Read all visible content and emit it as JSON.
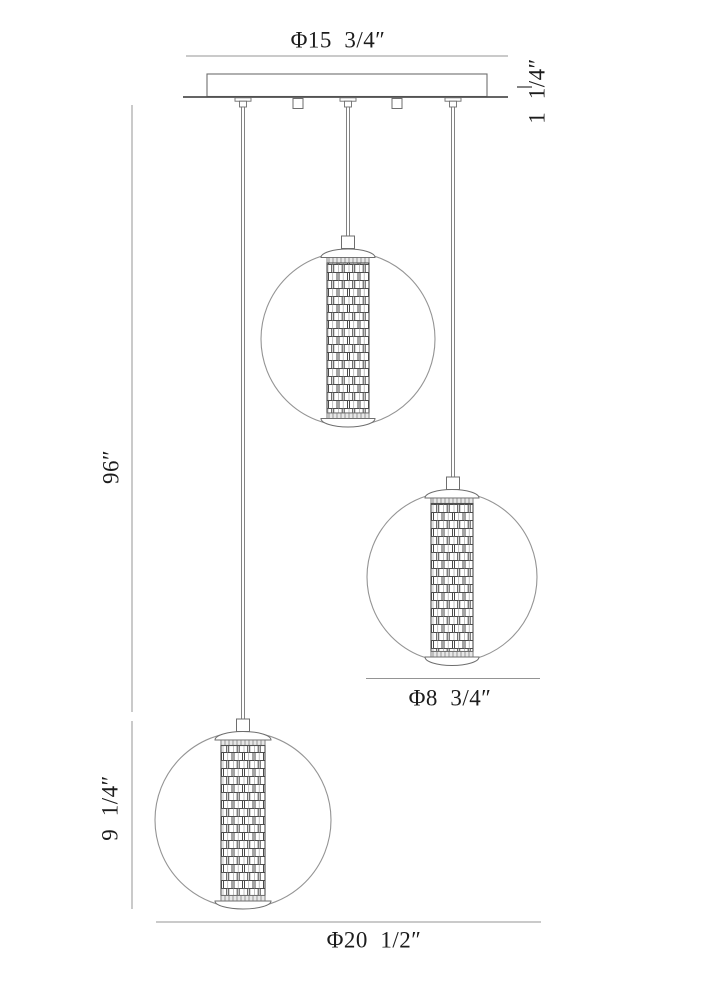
{
  "labels": {
    "canopy_diameter": "Φ15  3/4″",
    "canopy_height": "1  1/4″",
    "overall_drop": "96″",
    "lower_globe_drop": "9  1/4″",
    "globe_diameter": "Φ8  3/4″",
    "fixture_diameter": "Φ20  1/2″"
  },
  "colors": {
    "background": "#ffffff",
    "thin_line": "#949494",
    "outline": "#6e6e6e",
    "dark_line": "#4f4f4f",
    "weave_dark": "#4a4a4a",
    "weave_light": "#a6a6a6",
    "text": "#1c1c1c"
  }
}
